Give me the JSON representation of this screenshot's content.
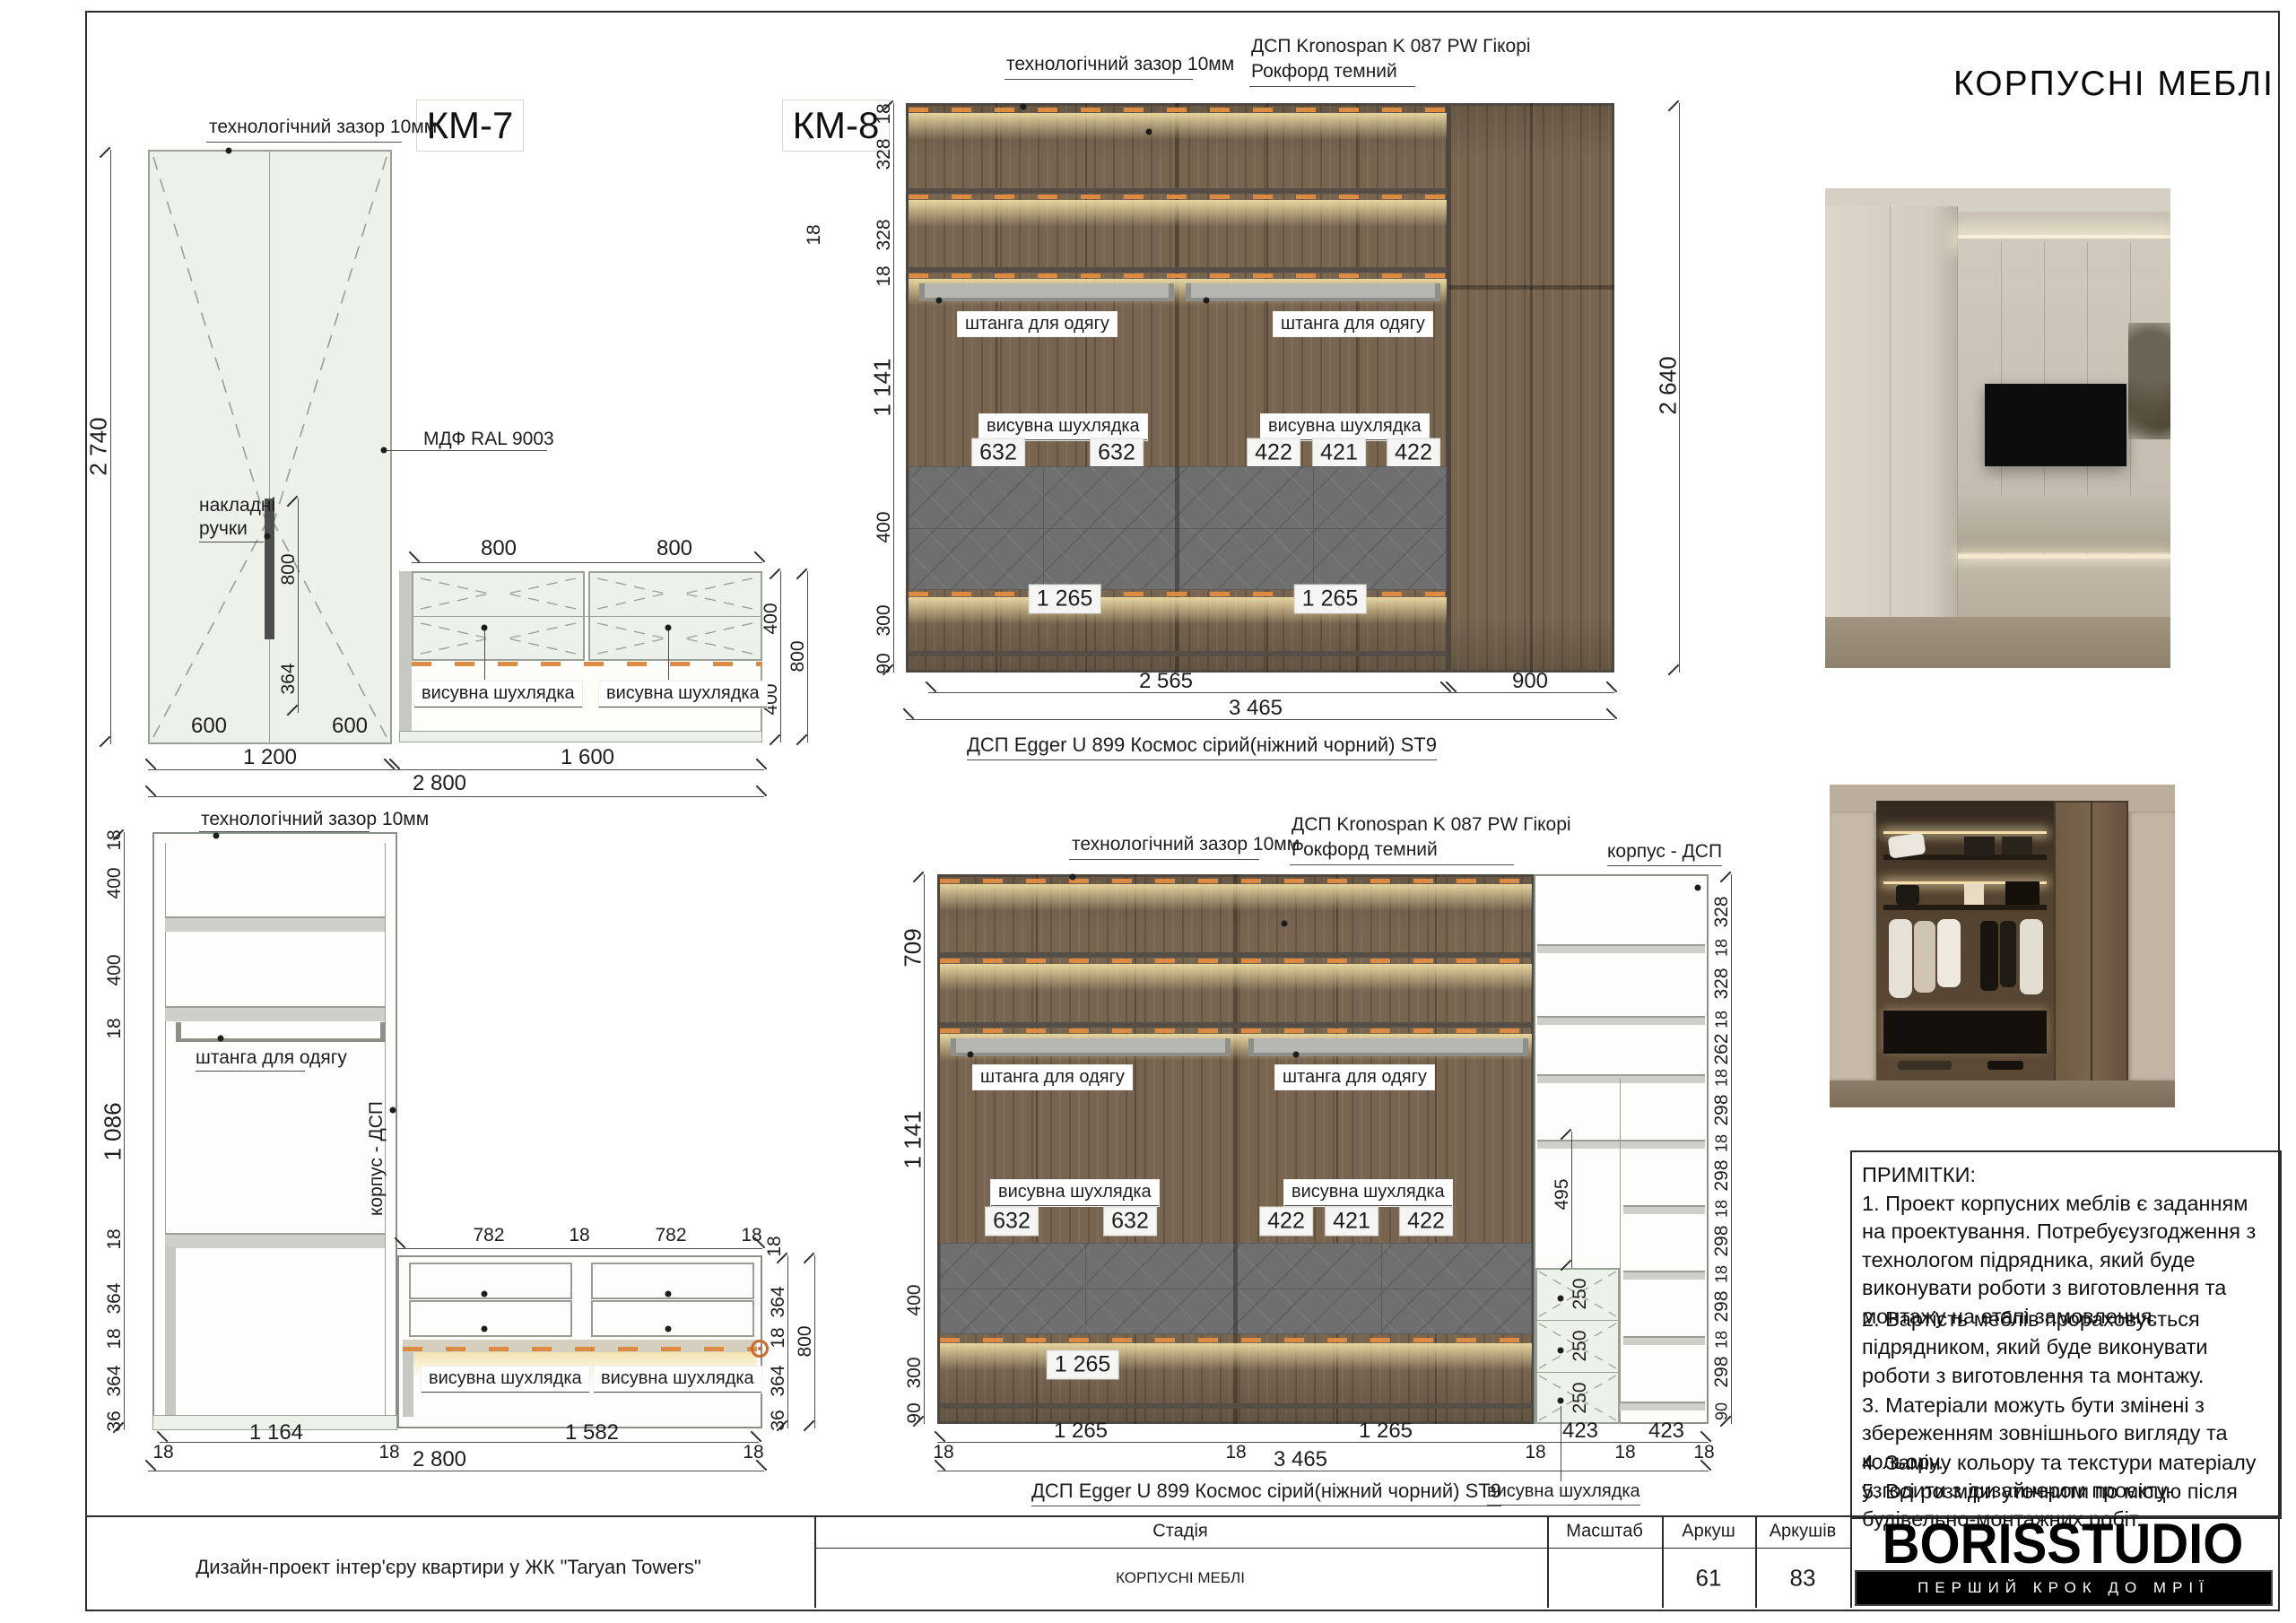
{
  "sheet": {
    "title": "КОРПУСНІ МЕБЛІ"
  },
  "drawings": {
    "km7": "КМ-7",
    "km8": "КМ-8"
  },
  "labels": {
    "tech_gap": "технологічний зазор 10мм",
    "mdf": "МДФ RAL 9003",
    "handles1": "накладні",
    "handles2": "ручки",
    "drawer": "висувна шухлядка",
    "rod": "штанга для одягу",
    "kronospan1": "ДСП Kronospan K 087 PW Гікорі",
    "kronospan2": "Рокфорд темний",
    "egger": "ДСП Egger U 899 Космос сірий(ніжний чорний) ST9",
    "korpus": "корпус - ДСП"
  },
  "km7_front": {
    "height": "2 740",
    "handle_len": "800",
    "handle_below": "364",
    "doors": [
      "600",
      "600"
    ],
    "bench_top": [
      "800",
      "800"
    ],
    "bench_right": [
      "400",
      "400"
    ],
    "bench_right_total": "800",
    "bottom": [
      "1 200",
      "1 600"
    ],
    "bottom_total": "2 800"
  },
  "km7_side": {
    "left_chain": [
      "18",
      "400",
      "400",
      "18",
      "1 086",
      "18",
      "364",
      "18",
      "364",
      "36"
    ],
    "top_dims": [
      "782",
      "18",
      "782",
      "18"
    ],
    "corner": "18",
    "right_chain": [
      "364",
      "18",
      "364",
      "36"
    ],
    "right_total": "800",
    "bottom": [
      "18",
      "1 164",
      "18",
      "1 582",
      "18"
    ],
    "bottom_total": "2 800"
  },
  "km8_front": {
    "left_chain": [
      "18",
      "328",
      "328",
      "18"
    ],
    "side_panel": "18",
    "left_lower": [
      "1 141",
      "400",
      "300",
      "90"
    ],
    "drawer_widths": [
      "632",
      "632",
      "422",
      "421",
      "422"
    ],
    "module_widths": [
      "1 265",
      "1 265"
    ],
    "bottom": [
      "2 565",
      "900"
    ],
    "bottom_total": "3 465",
    "height": "2 640"
  },
  "km8_side": {
    "left_chain": [
      "709",
      "1 141",
      "400",
      "300",
      "90"
    ],
    "drawer_widths": [
      "632",
      "632",
      "422",
      "421",
      "422"
    ],
    "module_width": "1 265",
    "hang_height": "495",
    "drawer_heights": [
      "250",
      "250",
      "250"
    ],
    "right_chain": [
      "328",
      "18",
      "328",
      "18",
      "262",
      "18",
      "298",
      "18",
      "298",
      "18",
      "298",
      "18",
      "298",
      "18",
      "298",
      "90"
    ],
    "bottom": [
      "18",
      "1 265",
      "18",
      "1 265",
      "18",
      "423",
      "18",
      "423",
      "18"
    ],
    "bottom_total": "3 465"
  },
  "notes": {
    "title": "ПРИМІТКИ:",
    "items": [
      "1. Проект корпусних меблів є заданням на проектування. Потребуєузгодження з технологом підрядника, який буде виконувати роботи з виготовлення та монтажу на етапі замовлення.",
      "2. Вартість меблів прораховується підрядником, який буде виконувати роботи з виготовлення та монтажу.",
      "3. Матеріали можуть бути змінені з збереженням зовнішнього вигляду та кольору.",
      "4. Заміну кольору та текстури матеріалу узгодити з дизайнером проєкту.",
      "5. Всі розміри уточнити по місцю після будівельно-монтажних робіт."
    ]
  },
  "titleblock": {
    "project": "Дизайн-проект інтер'єру квартири у ЖК \"Taryan Towers\"",
    "stage_h": "Стадія",
    "scale_h": "Масштаб",
    "sheet_h": "Аркуш",
    "sheets_h": "Аркушів",
    "stage": "КОРПУСНІ МЕБЛІ",
    "sheet": "61",
    "sheets": "83",
    "logo": "BORISSTUDIO",
    "tagline": "ПЕРШИЙ КРОК ДО МРІЇ"
  },
  "colors": {
    "led_orange": "#dd8a43",
    "drawing_green": "#ecf1ea",
    "wood_brown": "#786550",
    "drawer_grey": "#6f6f6f"
  }
}
